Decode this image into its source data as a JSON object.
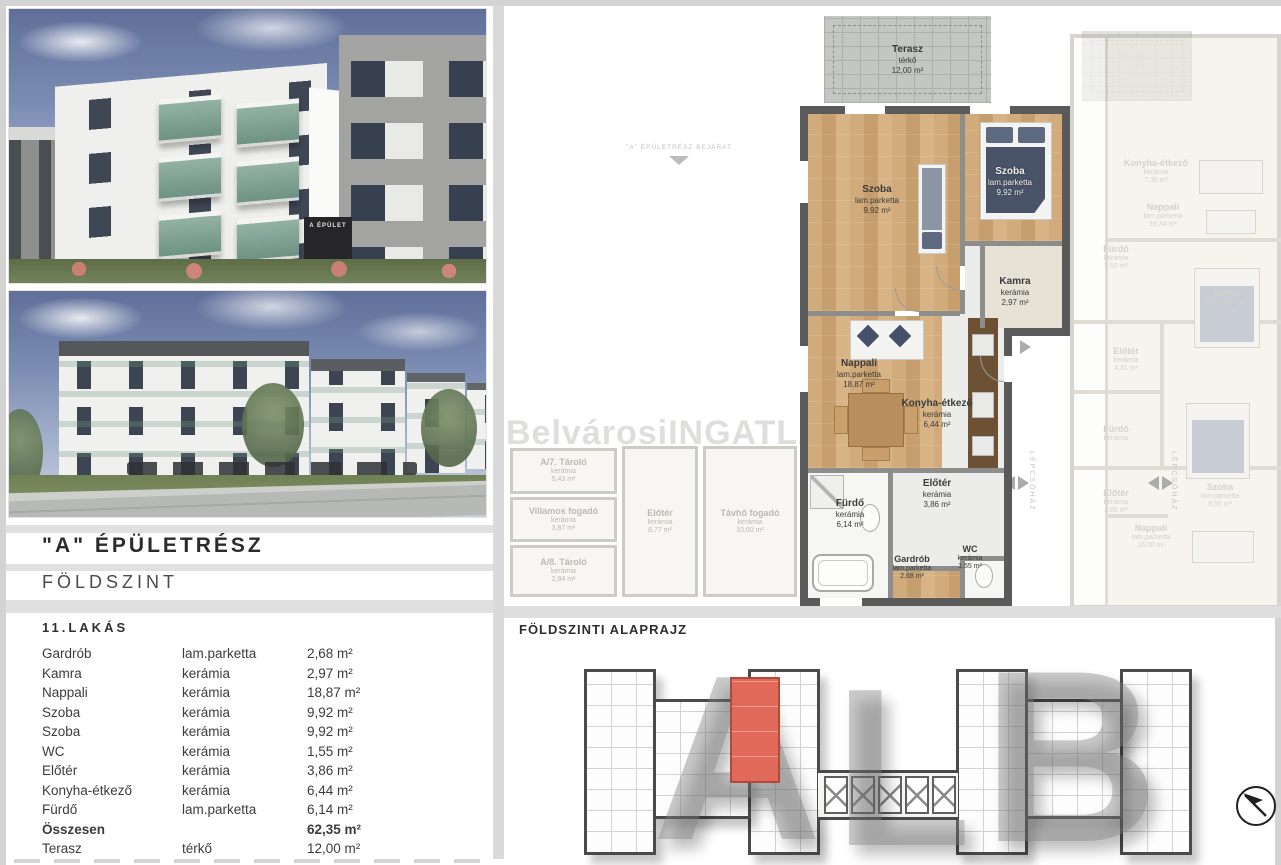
{
  "colors": {
    "highlight_unit": "#e0695a",
    "wall_dark": "#5a5a5a",
    "wood_floor": "#cfa87a",
    "faded_text": "#b2aca3"
  },
  "left": {
    "photo1": {
      "sign": "A ÉPÜLET"
    },
    "building_title": "\"A\" ÉPÜLETRÉSZ",
    "floor_title": "FÖLDSZINT",
    "table": {
      "title": "11.LAKÁS",
      "rows": [
        {
          "room": "Gardrób",
          "material": "lam.parketta",
          "area": "2,68 m²"
        },
        {
          "room": "Kamra",
          "material": "kerámia",
          "area": "2,97 m²"
        },
        {
          "room": "Nappali",
          "material": "kerámia",
          "area": "18,87 m²"
        },
        {
          "room": "Szoba",
          "material": "kerámia",
          "area": "9,92 m²"
        },
        {
          "room": "Szoba",
          "material": "kerámia",
          "area": "9,92 m²"
        },
        {
          "room": "WC",
          "material": "kerámia",
          "area": "1,55 m²"
        },
        {
          "room": "Előtér",
          "material": "kerámia",
          "area": "3,86 m²"
        },
        {
          "room": "Konyha-étkező",
          "material": "kerámia",
          "area": "6,44 m²"
        },
        {
          "room": "Fürdő",
          "material": "lam.parketta",
          "area": "6,14 m²"
        },
        {
          "room": "Összesen",
          "material": "",
          "area": "62,35 m²"
        },
        {
          "room": "Terasz",
          "material": "térkő",
          "area": "12,00 m²"
        }
      ]
    }
  },
  "plan": {
    "watermark": "BelvárosiINGATLANPont",
    "entrance_label": "\"A\" ÉPÜLETRÉSZ BEJÁRAT",
    "stair_label": "LÉPCSŐHÁZ",
    "terrace": {
      "name": "Terasz",
      "material": "térkő",
      "area": "12,00 m²"
    },
    "terrace_faded": {
      "name": "Terasz",
      "material": "térkő",
      "area": "12,00 m²"
    },
    "rooms": [
      {
        "name": "Szoba",
        "material": "lam.parketta",
        "area": "9,92 m²"
      },
      {
        "name": "Szoba",
        "material": "lam.parketta",
        "area": "9,92 m²"
      },
      {
        "name": "Kamra",
        "material": "kerámia",
        "area": "2,97 m²"
      },
      {
        "name": "Nappali",
        "material": "lam.parketta",
        "area": "18,87 m²"
      },
      {
        "name": "Konyha-étkező",
        "material": "kerámia",
        "area": "6,44 m²"
      },
      {
        "name": "Előtér",
        "material": "kerámia",
        "area": "3,86 m²"
      },
      {
        "name": "Fürdő",
        "material": "kerámia",
        "area": "6,14 m²"
      },
      {
        "name": "Gardrób",
        "material": "lam.parketta",
        "area": "2,68 m²"
      },
      {
        "name": "WC",
        "material": "kerámia",
        "area": "1,55 m²"
      }
    ],
    "annex": [
      {
        "name": "A/7. Tároló",
        "material": "kerámia",
        "area": "5,43 m²"
      },
      {
        "name": "Villamos fogadó",
        "material": "kerámia",
        "area": "3,87 m²"
      },
      {
        "name": "A/8. Tároló",
        "material": "kerámia",
        "area": "2,84 m²"
      },
      {
        "name": "Előtér",
        "material": "kerámia",
        "area": "8,77 m²"
      },
      {
        "name": "Távhő fogadó",
        "material": "kerámia",
        "area": "10,60 m²"
      }
    ],
    "neighbor": [
      {
        "name": "Konyha-étkező",
        "material": "kerámia",
        "area": "7,36 m²"
      },
      {
        "name": "Nappali",
        "material": "lam.parketta",
        "area": "16,34 m²"
      },
      {
        "name": "Fürdő",
        "material": "kerámia",
        "area": "3,50 m²"
      },
      {
        "name": "Szoba",
        "material": "lam.parketta",
        "area": "9,64 m²"
      },
      {
        "name": "Előtér",
        "material": "kerámia",
        "area": "4,31 m²"
      },
      {
        "name": "Fürdő",
        "material": "kerámia",
        "area": ""
      },
      {
        "name": "Előtér",
        "material": "kerámia",
        "area": "2,86 m²"
      },
      {
        "name": "Szoba",
        "material": "lam.parketta",
        "area": "8,55 m²"
      },
      {
        "name": "Nappali",
        "material": "lam.parketta",
        "area": "16,00 m²"
      }
    ]
  },
  "bottom": {
    "heading": "FÖLDSZINTI ALAPRAJZ",
    "letters": [
      "A",
      "L",
      "B"
    ]
  }
}
